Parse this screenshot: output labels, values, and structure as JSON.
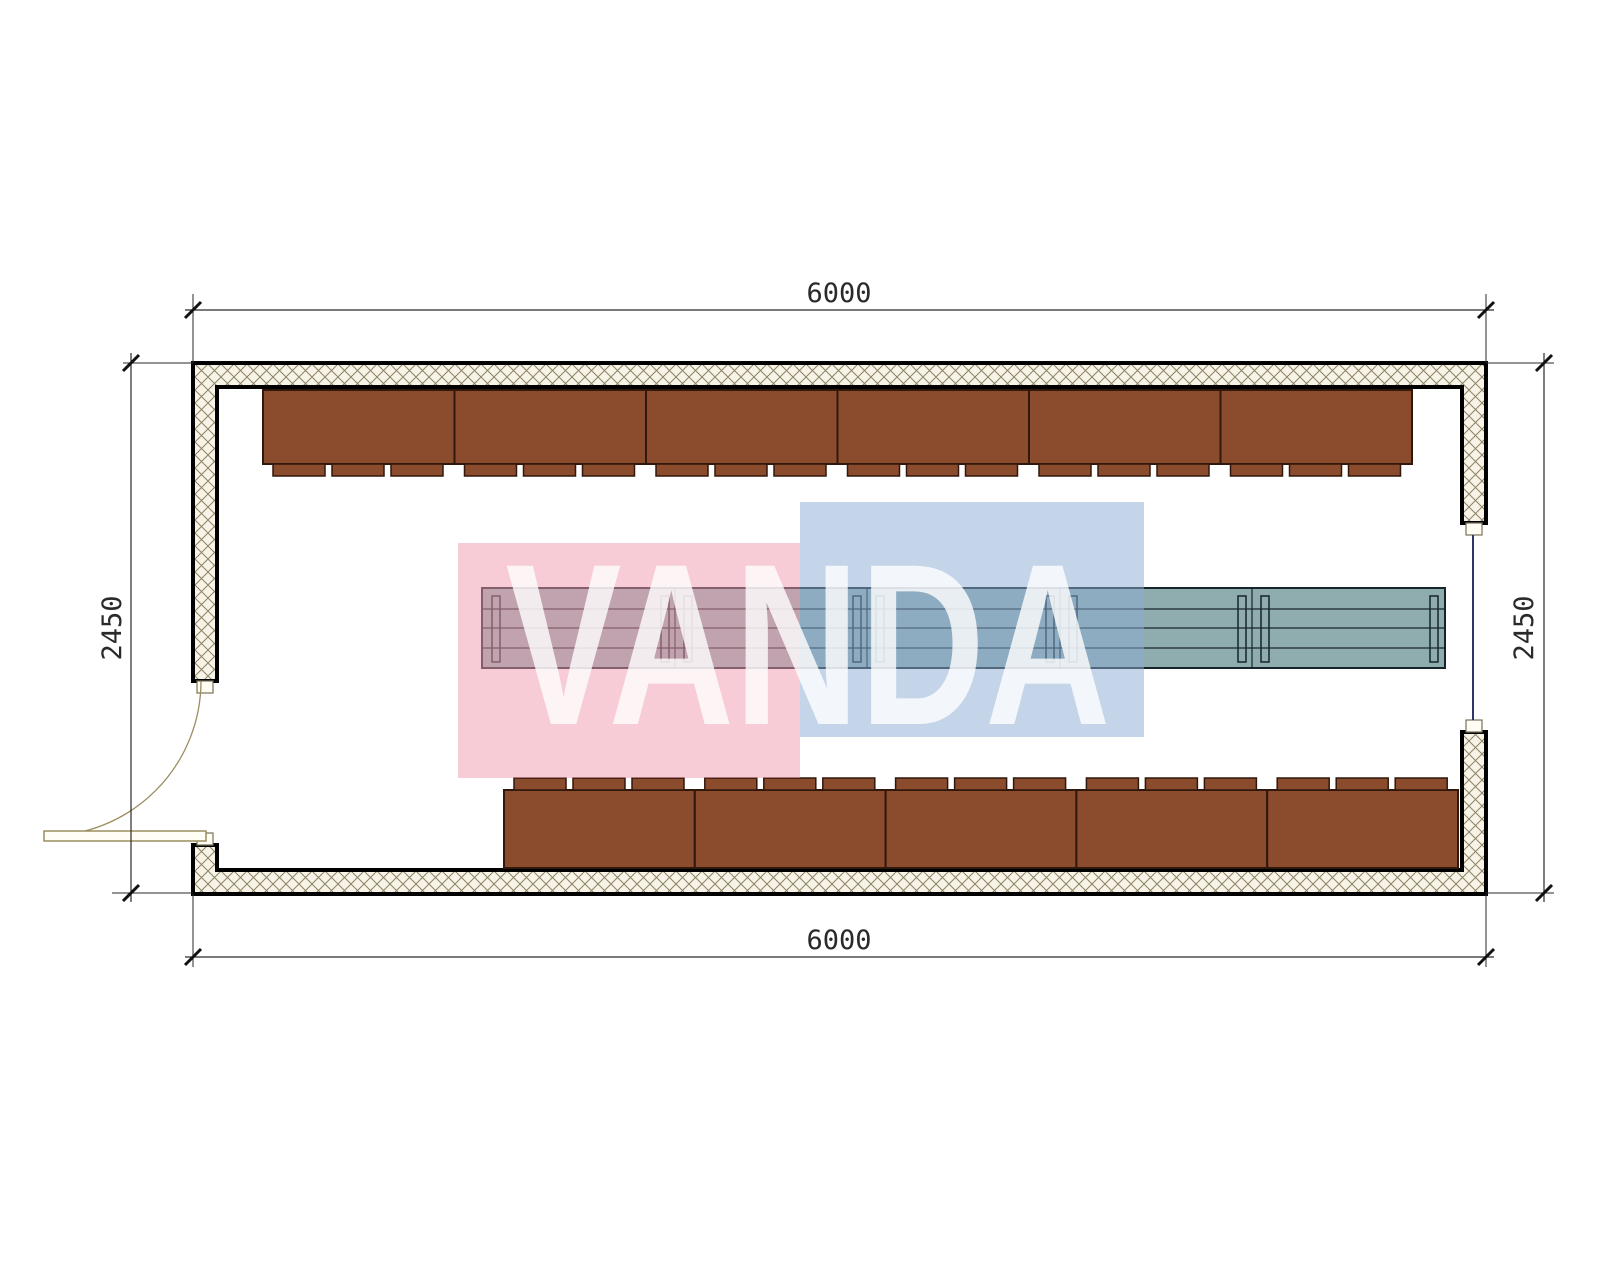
{
  "drawing": {
    "type_label": "floor-plan",
    "watermark": {
      "text": "VANDA",
      "text_color": "#ffffff",
      "pink_color": "#f199ad",
      "blue_color": "#8babd3"
    },
    "dimensions": {
      "top": "6000",
      "bottom": "6000",
      "left": "2450",
      "right": "2450"
    },
    "colors": {
      "bench": "#8b4b2d",
      "bench_outline": "#30180c",
      "table": "#8fadae",
      "table_outline": "#16242b",
      "wall_fill": "#f7f3e6",
      "wall_hatch_line": "#8c8266",
      "wall_outline": "#000000",
      "door": "#9a8d60",
      "window_glazing": "#2c3766",
      "dimension_lines": "#2a2a2a"
    },
    "elements": {
      "top_bench_count": 6,
      "bottom_bench_count": 5,
      "table_segment_count": 5,
      "door_count": 1,
      "window_count": 1
    }
  }
}
